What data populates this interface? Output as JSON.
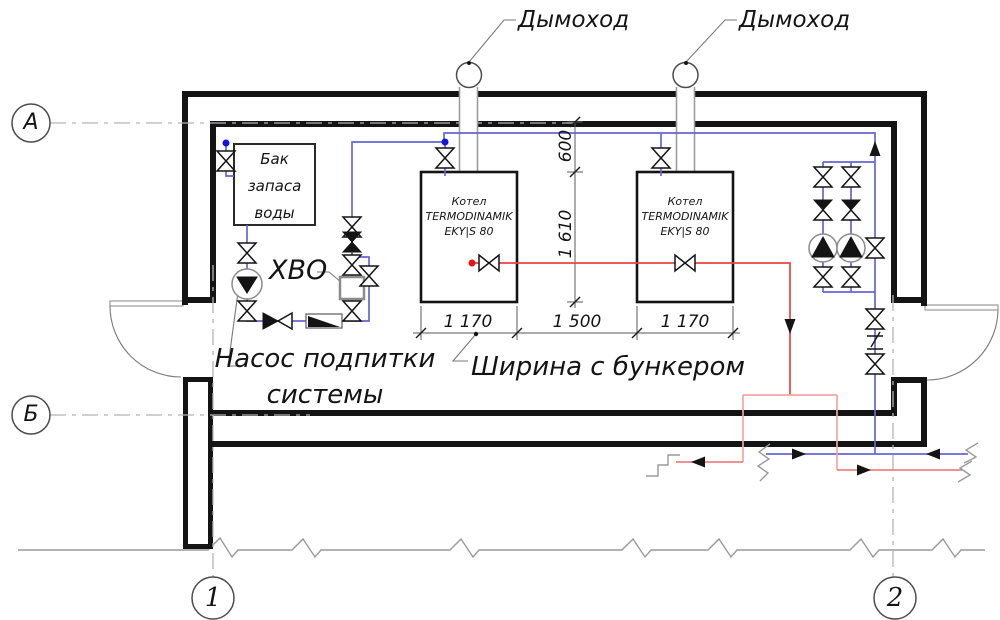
{
  "drawing": {
    "chimney_labels": [
      "Дымоход",
      "Дымоход"
    ],
    "axes": {
      "a": "А",
      "b": "Б",
      "n1": "1",
      "n2": "2"
    },
    "tank": {
      "line1": "Бак",
      "line2": "запаса",
      "line3": "воды"
    },
    "boiler1": {
      "line1": "Котел",
      "line2": "TERMODINAMIK",
      "line3": "EKY|S 80"
    },
    "boiler2": {
      "line1": "Котел",
      "line2": "TERMODINAMIK",
      "line3": "EKY|S 80"
    },
    "hvo_label": "ХВО",
    "makeup_pump_label": {
      "line1": "Насос подпитки",
      "line2": "системы"
    },
    "width_note": "Ширина с бункером",
    "dimensions": {
      "top": "600",
      "side": "1 610",
      "left": "1 170",
      "middle": "1 500",
      "right": "1 170"
    },
    "colors": {
      "cold_pipe": "#6666d4",
      "hot_pipe": "#e94343",
      "hot_pipe_light": "#f2a6a6",
      "hot_pipe_mid": "#ef8282",
      "supply_dot": "#1414e0",
      "hot_dot": "#e81414",
      "wall": "#141414"
    }
  }
}
